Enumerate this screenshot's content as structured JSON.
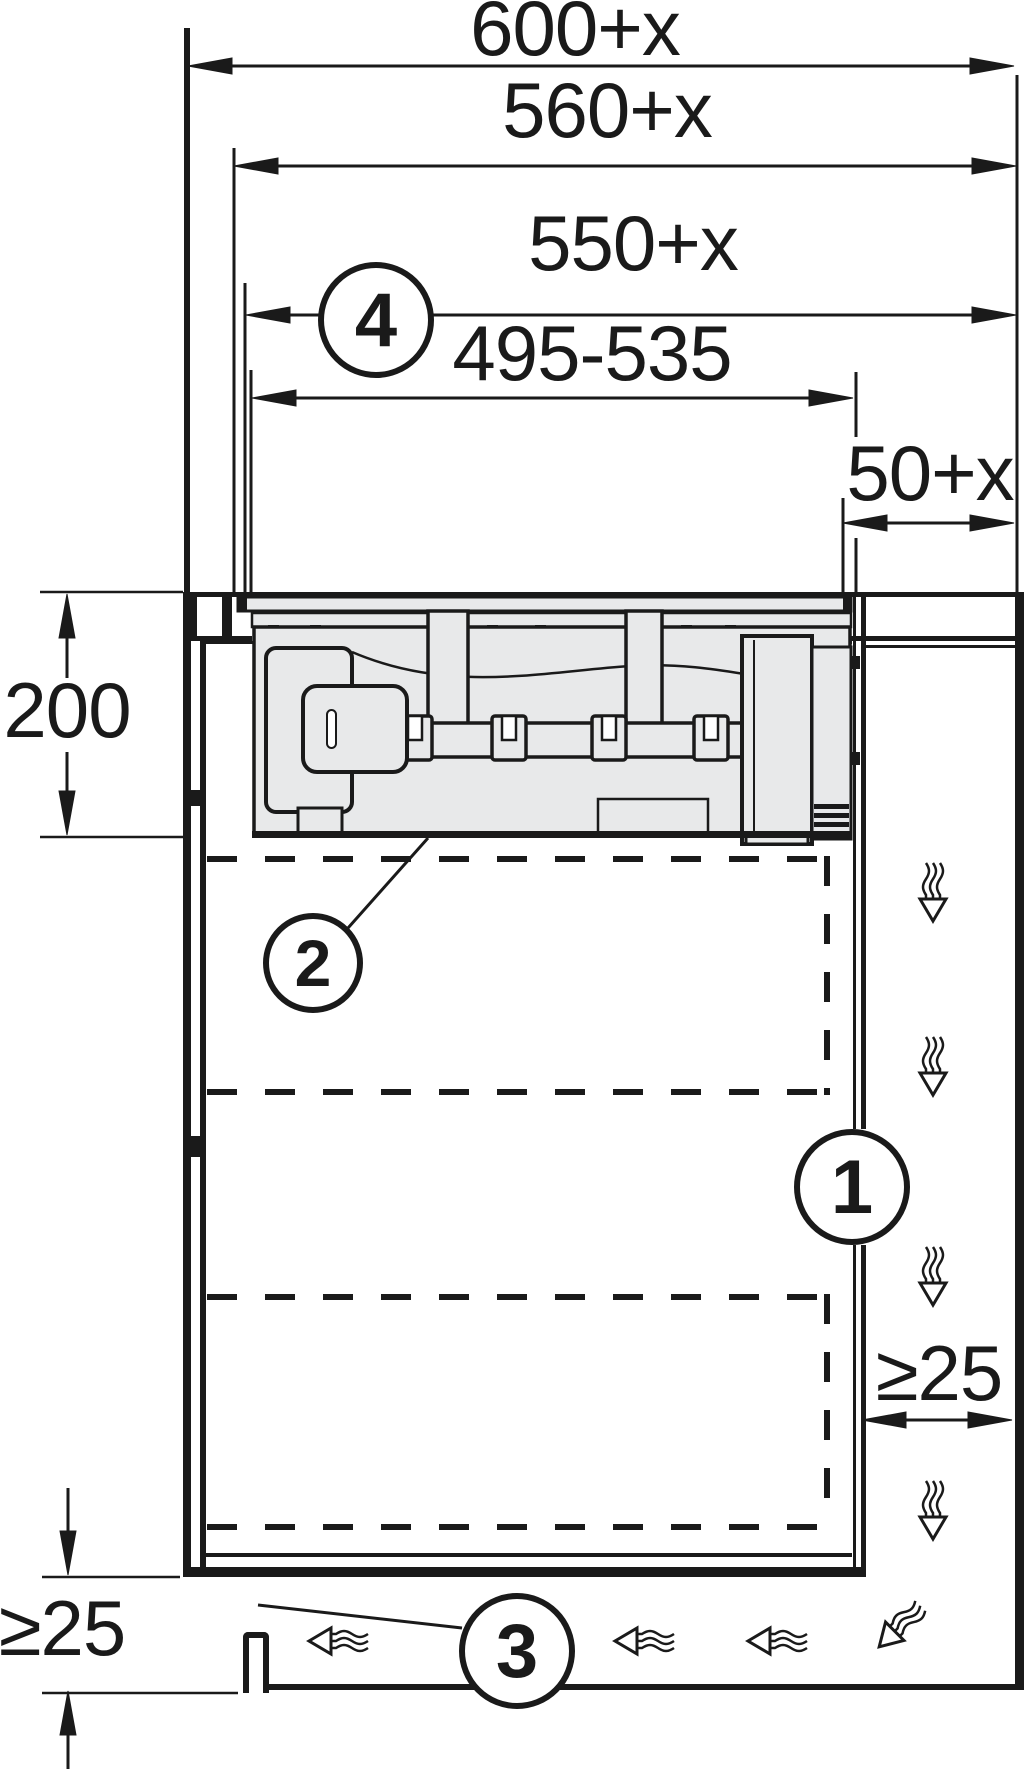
{
  "title": "Appliance built-in installation cross-section",
  "colors": {
    "line": "#1a1a1a",
    "fill": "#e8e9ea",
    "background": "#ffffff"
  },
  "dimension_labels": {
    "d600": "600+x",
    "d560": "560+x",
    "d550": "550+x",
    "d495": "495-535",
    "d50": "50+x",
    "d200": "200",
    "min25_side": "≥25",
    "min25_bottom": "≥25"
  },
  "callouts": {
    "c1": "1",
    "c2": "2",
    "c3": "3",
    "c4": "4"
  },
  "icons": {
    "airflow_down": "airflow-down-icon",
    "airflow_left": "airflow-left-icon",
    "airflow_turn": "airflow-turn-icon"
  }
}
